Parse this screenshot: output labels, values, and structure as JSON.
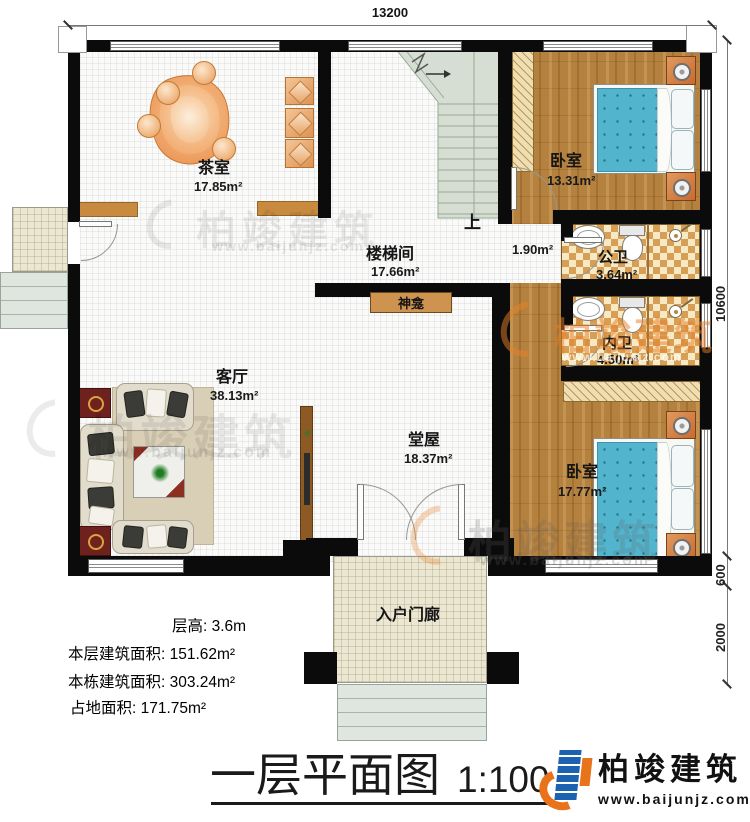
{
  "drawing": {
    "title": "一层平面图",
    "scale": "1:100",
    "dims": {
      "width": "13200",
      "height": "10600",
      "offset": "600",
      "porch_depth": "2000"
    },
    "stats": {
      "floor_height": "层高: 3.6m",
      "floor_area": "本层建筑面积: 151.62m²",
      "total_area": "本栋建筑面积: 303.24m²",
      "footprint": "占地面积: 171.75m²"
    },
    "rooms": {
      "tea_room": {
        "name": "茶室",
        "area": "17.85m²"
      },
      "stair_hall": {
        "name": "楼梯间",
        "area": "17.66m²"
      },
      "stair_up": {
        "label": "上"
      },
      "hallway": {
        "area": "1.90m²"
      },
      "bedroom_top": {
        "name": "卧室",
        "area": "13.31m²"
      },
      "public_bath": {
        "name": "公卫",
        "area": "3.64m²"
      },
      "inner_bath": {
        "name": "内卫",
        "area": "4.50m²"
      },
      "bedroom_bottom": {
        "name": "卧室",
        "area": "17.77m²"
      },
      "living_room": {
        "name": "客厅",
        "area": "38.13m²"
      },
      "main_hall": {
        "name": "堂屋",
        "area": "18.37m²"
      },
      "entry_porch": {
        "name": "入户门廊"
      },
      "shrine": {
        "name": "神龛"
      }
    },
    "brand": {
      "name": "柏竣建筑",
      "url": "www.baijunjz.com"
    },
    "colors": {
      "wall": "#0b0b0b",
      "wood": "#b5813e",
      "stair": "#d6ded4",
      "bed": "#52b4cd",
      "accent_orange": "#e8731a",
      "accent_blue": "#1b62b0"
    }
  }
}
